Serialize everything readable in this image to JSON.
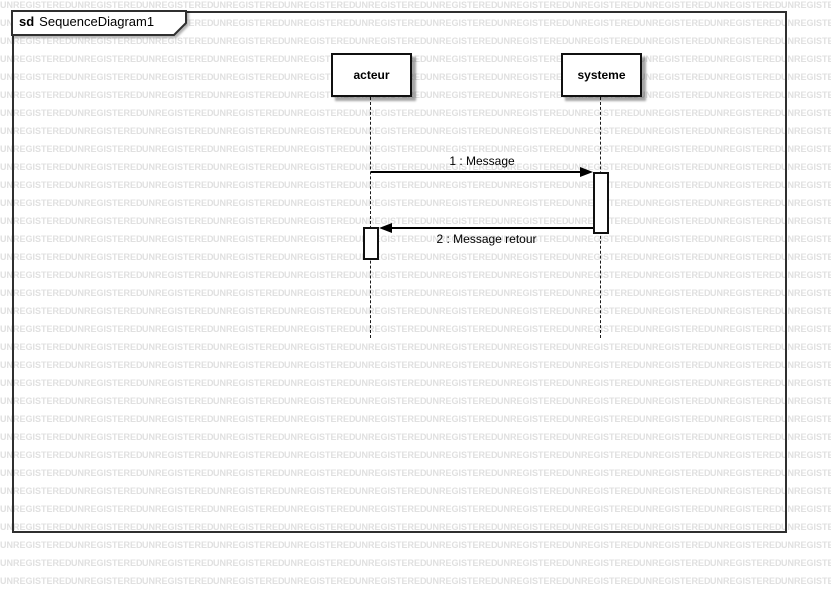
{
  "watermark": {
    "text": "UNREGISTERED",
    "color": "#e0e0e0"
  },
  "frame": {
    "keyword": "sd",
    "title": "SequenceDiagram1"
  },
  "lifelines": [
    {
      "name": "acteur"
    },
    {
      "name": "systeme"
    }
  ],
  "messages": [
    {
      "label": "1 : Message",
      "direction": "right"
    },
    {
      "label": "2 : Message retour",
      "direction": "left"
    }
  ],
  "colors": {
    "background": "#ffffff",
    "frame_border": "#2f2f2f",
    "element_border": "#101010",
    "line": "#000000",
    "watermark": "#e0e0e0"
  }
}
